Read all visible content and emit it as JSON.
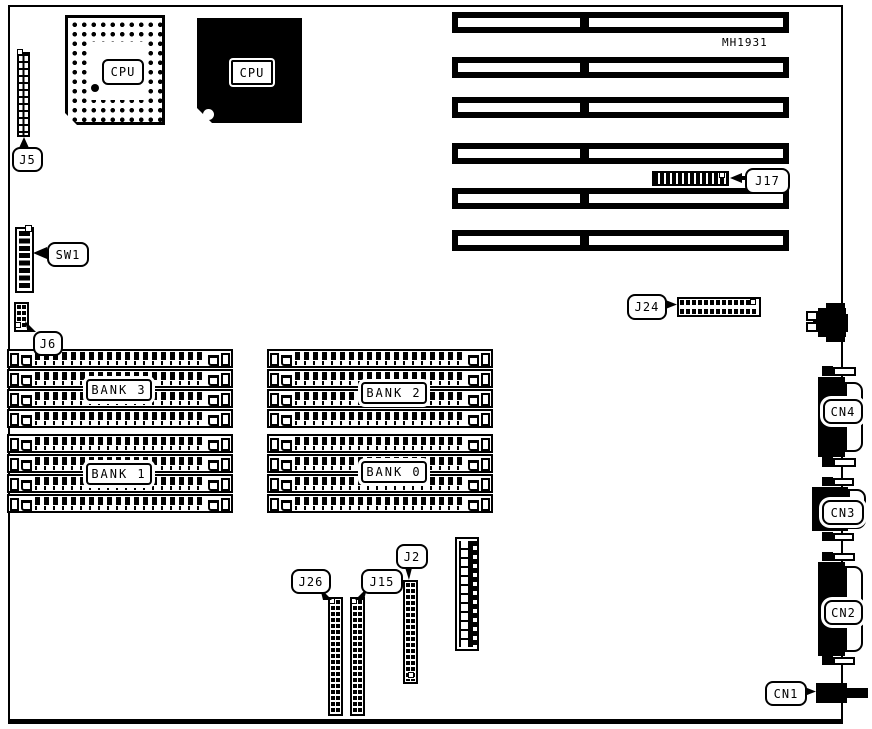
{
  "board": {
    "part_number": "MH1931"
  },
  "chips": {
    "socket_label": "CPU",
    "chip_label": "CPU"
  },
  "banks": {
    "bank3": "BANK 3",
    "bank2": "BANK 2",
    "bank1": "BANK 1",
    "bank0": "BANK 0"
  },
  "callouts": {
    "j5": "J5",
    "sw1": "SW1",
    "j6": "J6",
    "j17": "J17",
    "j24": "J24",
    "j26": "J26",
    "j15": "J15",
    "j2": "J2",
    "cn1": "CN1",
    "cn2": "CN2",
    "cn3": "CN3",
    "cn4": "CN4"
  },
  "colors": {
    "ink": "#000000",
    "paper": "#ffffff"
  }
}
